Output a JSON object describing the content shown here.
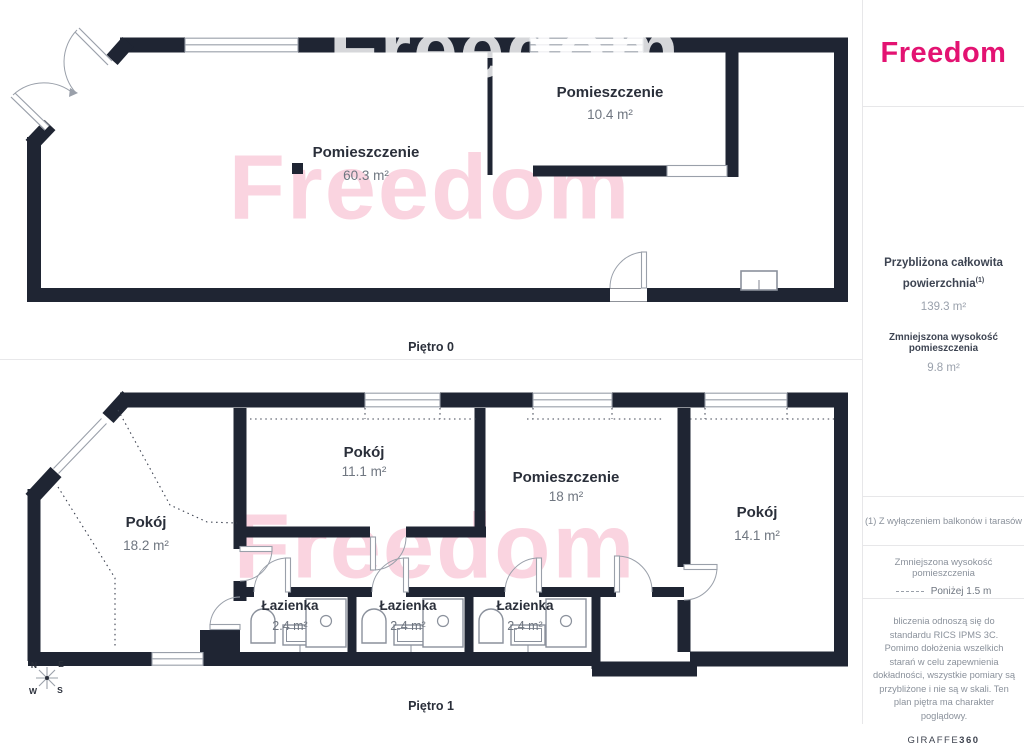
{
  "watermark": {
    "text": "Freedom"
  },
  "floors": {
    "f0": {
      "label": "Piętro 0",
      "rooms": {
        "main": {
          "name": "Pomieszczenie",
          "area": "60.3 m²"
        },
        "top": {
          "name": "Pomieszczenie",
          "area": "10.4 m²"
        }
      }
    },
    "f1": {
      "label": "Piętro 1",
      "rooms": {
        "pokoj_left": {
          "name": "Pokój",
          "area": "18.2 m²"
        },
        "pokoj_mid": {
          "name": "Pokój",
          "area": "11.1 m²"
        },
        "pomieszczenie": {
          "name": "Pomieszczenie",
          "area": "18 m²"
        },
        "pokoj_right": {
          "name": "Pokój",
          "area": "14.1 m²"
        },
        "lazienka1": {
          "name": "Łazienka",
          "area": "2.4 m²"
        },
        "lazienka2": {
          "name": "Łazienka",
          "area": "2.4 m²"
        },
        "lazienka3": {
          "name": "Łazienka",
          "area": "2.4 m²"
        }
      }
    }
  },
  "compass": {
    "n": "N",
    "e": "E",
    "s": "S",
    "w": "W"
  },
  "sidebar": {
    "logo": "Freedom",
    "stats": {
      "total_label": "Przybliżona całkowita powierzchnia",
      "total_sup": "(1)",
      "total_value": "139.3 m²",
      "reduced_label": "Zmniejszona wysokość pomieszczenia",
      "reduced_value": "9.8 m²"
    },
    "footnote": "(1) Z wyłączeniem balkonów i tarasów",
    "legend": {
      "title": "Zmniejszona wysokość pomieszczenia",
      "value": "Poniżej 1.5 m"
    },
    "disclaimer": "bliczenia odnoszą się do standardu RICS IPMS 3C. Pomimo dołożenia wszelkich starań w celu zapewnienia dokładności, wszystkie pomiary są przybliżone i nie są w skali. Ten plan piętra ma charakter poglądowy.",
    "provider": {
      "name": "GIRAFFE",
      "suffix": "360"
    }
  },
  "colors": {
    "wall": "#1f2533",
    "brand_pink": "#e31372",
    "watermark_pink": "rgba(234,90,134,0.26)"
  }
}
